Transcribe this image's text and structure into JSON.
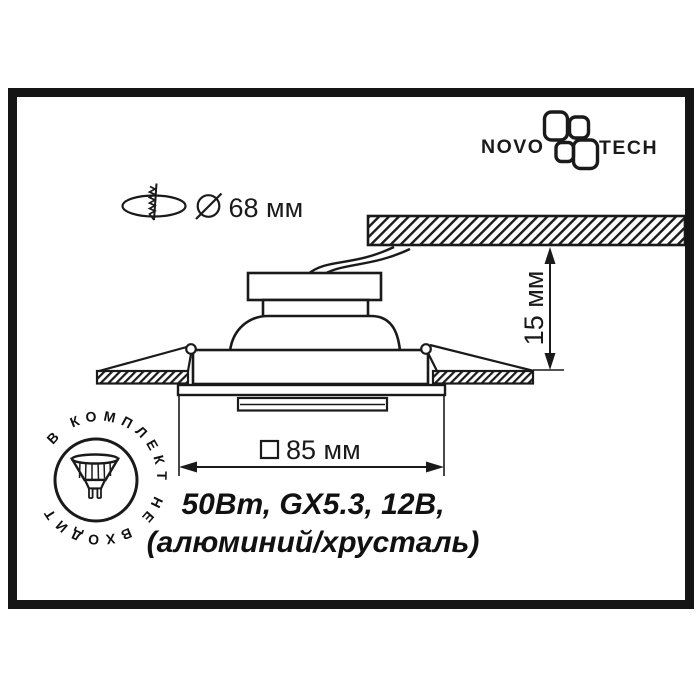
{
  "logo": {
    "novo": "NOVO",
    "tech": "TECH",
    "icon": "novotech-flower-icon"
  },
  "dimensions": {
    "cutout_label": "68 мм",
    "cutout_symbol": "diameter-icon",
    "width_label": "85 мм",
    "width_symbol": "square-icon",
    "depth_label": "15 мм"
  },
  "specs": {
    "line1": "50Вт, GX5.3, 12В,",
    "line2": "(алюминий/хрусталь)"
  },
  "stamp": {
    "text": "В КОМПЛЕКТ НЕ ВХОДИТ",
    "icon": "mr16-lamp-icon"
  },
  "icons": {
    "mounting": "screw-through-ceiling-icon",
    "diameter": "diameter-icon",
    "square": "square-icon",
    "lamp": "mr16-lamp-icon",
    "logo": "novotech-flower-icon"
  },
  "colors": {
    "ink": "#1a1a1a",
    "background": "#ffffff"
  }
}
